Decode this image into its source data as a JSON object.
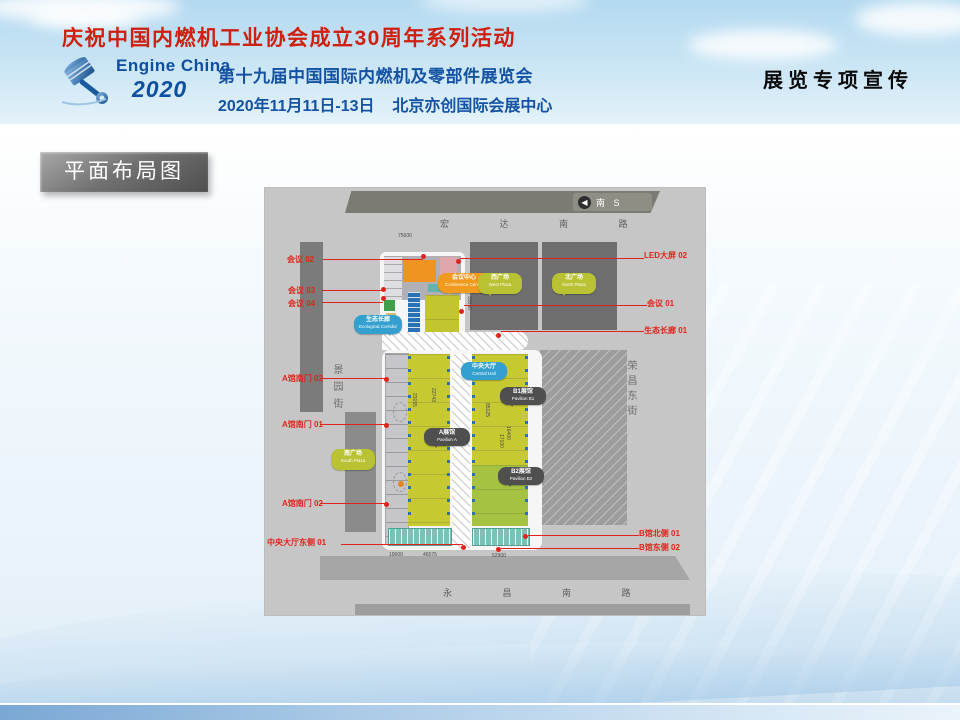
{
  "header": {
    "banner_title": "庆祝中国内燃机工业协会成立30周年系列活动",
    "logo": {
      "line1": "Engine China",
      "line2": "2020"
    },
    "expo_title": "第十九届中国国际内燃机及零部件展览会",
    "expo_date_venue": "2020年11月11日-13日    北京亦创国际会展中心",
    "right_label": "展览专项宣传"
  },
  "section_title": "平面布局图",
  "map": {
    "compass_label": "南 S",
    "roads": {
      "north": "宏 达 南 路",
      "south": "永 昌 南 路",
      "west": "景园街",
      "east": "荣昌东街"
    },
    "callouts": [
      {
        "id": "conference-center",
        "zh": "会议中心",
        "en": "Conference Center"
      },
      {
        "id": "west-plaza",
        "zh": "西广场",
        "en": "West Plaza"
      },
      {
        "id": "north-plaza",
        "zh": "北广场",
        "en": "North Plaza"
      },
      {
        "id": "eco-corridor",
        "zh": "生态长廊",
        "en": "Ecological Corridor"
      },
      {
        "id": "central-hall",
        "zh": "中央大厅",
        "en": "Central Hall"
      },
      {
        "id": "pavilion-a",
        "zh": "A展馆",
        "en": "Pavilion A"
      },
      {
        "id": "pavilion-b1",
        "zh": "B1展馆",
        "en": "Pavilion B1"
      },
      {
        "id": "pavilion-b2",
        "zh": "B2展馆",
        "en": "Pavilion B2"
      },
      {
        "id": "south-plaza",
        "zh": "南广场",
        "en": "South Plaza"
      }
    ],
    "labels": [
      {
        "text": "会议 02"
      },
      {
        "text": "LED大屏 02"
      },
      {
        "text": "会议 03"
      },
      {
        "text": "会议 04"
      },
      {
        "text": "会议 01"
      },
      {
        "text": "生态长廊 01"
      },
      {
        "text": "A馆南门 02"
      },
      {
        "text": "A馆南门 01"
      },
      {
        "text": "A馆南门 02"
      },
      {
        "text": "中央大厅东侧 01"
      },
      {
        "text": "B馆北侧 01"
      },
      {
        "text": "B馆东侧 02"
      }
    ],
    "measurements": [
      "75600",
      "33030",
      "23155",
      "22743",
      "85125",
      "16400",
      "17100",
      "19600",
      "46575",
      "52900"
    ]
  },
  "colors": {
    "label_red": "#e0241b",
    "hall_yellow": "#c6c931",
    "hall_green": "#a5c242",
    "callout_orange": "#f09a1e",
    "callout_olive": "#b9c232",
    "callout_blue": "#33a0cf",
    "callout_dark": "#4f4f4f",
    "title_red": "#cf1f0e",
    "brand_blue": "#0d4fa0"
  }
}
